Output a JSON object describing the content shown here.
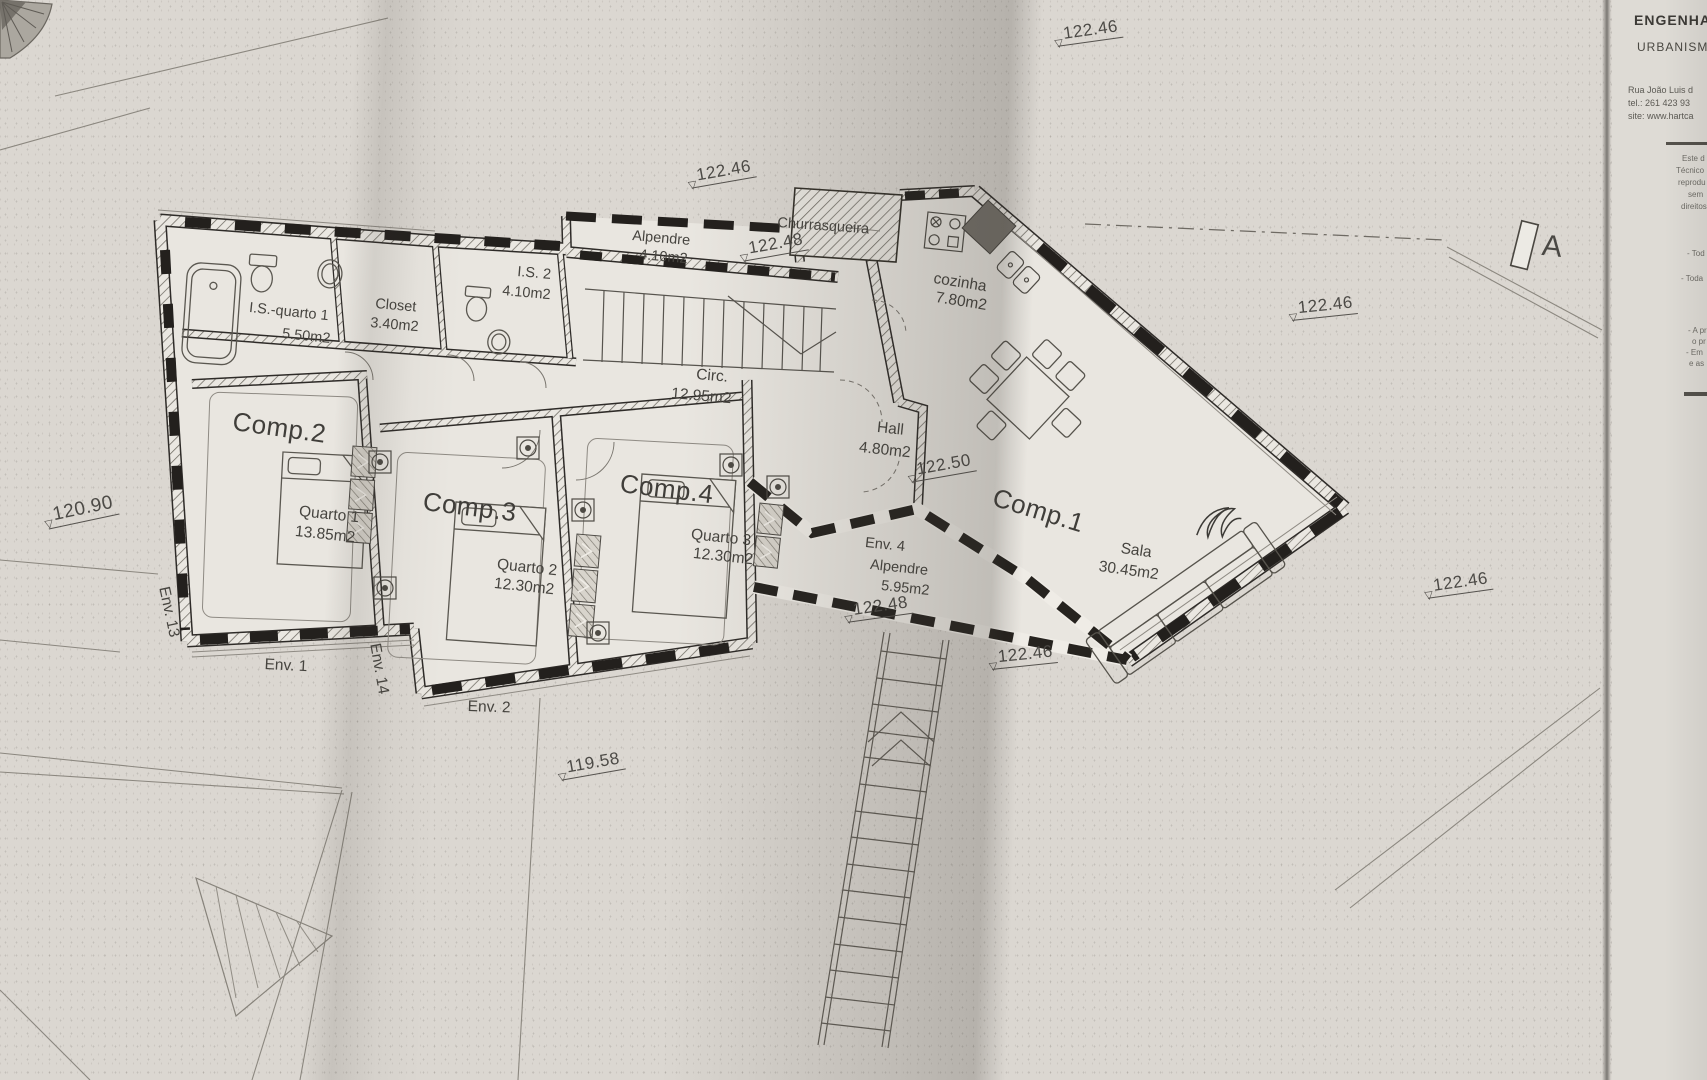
{
  "plan": {
    "marker_a": "A",
    "rooms": {
      "comp1": {
        "label": "Comp.1",
        "name": "Sala",
        "area": "30.45m2"
      },
      "comp2": {
        "label": "Comp.2",
        "name": "Quarto 1",
        "area": "13.85m2"
      },
      "comp3": {
        "label": "Comp.3",
        "name": "Quarto 2",
        "area": "12.30m2"
      },
      "comp4": {
        "label": "Comp.4",
        "name": "Quarto 3",
        "area": "12.30m2"
      },
      "kitchen": {
        "name": "cozinha",
        "area": "7.80m2"
      },
      "hall": {
        "name": "Hall",
        "area": "4.80m2"
      },
      "circ": {
        "name": "Circ.",
        "area": "12.95m2"
      },
      "is_quarto1": {
        "name": "I.S.-quarto 1",
        "area": "5.50m2"
      },
      "is2": {
        "name": "I.S. 2",
        "area": "4.10m2"
      },
      "closet": {
        "name": "Closet",
        "area": "3.40m2"
      },
      "porch_top": {
        "name": "Alpendre",
        "area": "4.10m2"
      },
      "bbq": {
        "name": "Churrasqueira"
      },
      "env4_porch": {
        "label": "Env. 4",
        "name": "Alpendre",
        "area": "5.95m2"
      }
    },
    "env_labels": {
      "e1": "Env. 1",
      "e2": "Env. 2",
      "e13": "Env. 13",
      "e14": "Env. 14"
    },
    "elevations": [
      "122.46",
      "122.46",
      "122.48",
      "122.46",
      "122.50",
      "120.90",
      "122.48",
      "122.46",
      "122.46",
      "119.58"
    ]
  },
  "icons": {
    "elevation_triangle": "▽"
  },
  "title_block": {
    "line1": "ENGENHARIA",
    "line2": "URBANISMO",
    "address": [
      "Rua João Luis d",
      "tel.: 261 423 93",
      "site: www.hartca"
    ],
    "notes": [
      "Este d",
      "Técnico",
      "reprodu",
      "sem",
      "direitos"
    ],
    "bullets": [
      "- Tod",
      "- Toda",
      "- A pr",
      "o pr",
      "- Em",
      "e as"
    ]
  }
}
